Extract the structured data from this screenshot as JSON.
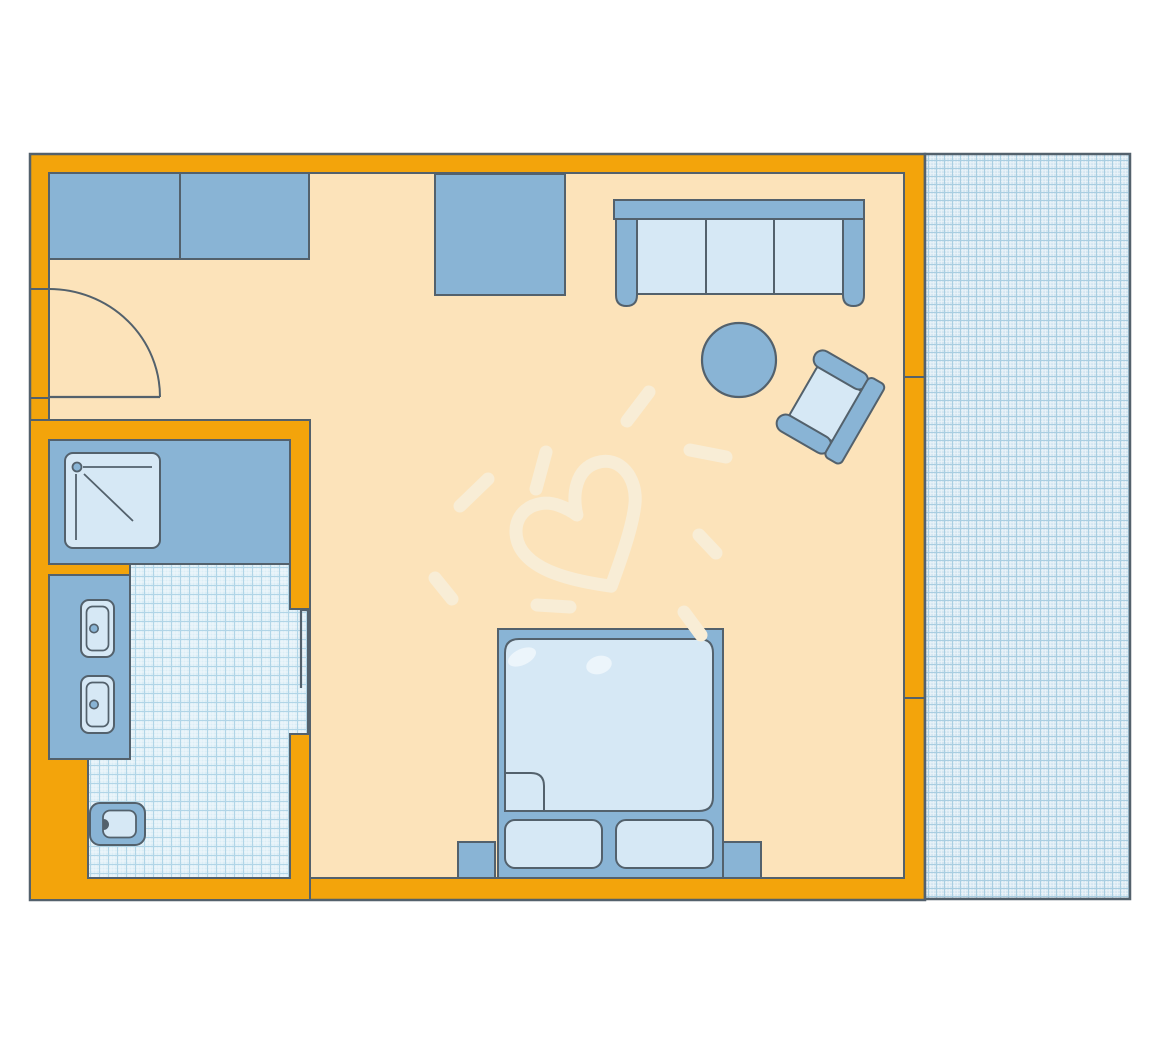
{
  "title": "hotel-room-floor-plan",
  "colors": {
    "page_bg": "#ffffff",
    "wall": "#F3A40B",
    "outline": "#53616C",
    "floor": "#FCE3BA",
    "furniture_blue": "#89B4D5",
    "furniture_light": "#D6E8F5",
    "balcony_bg": "#D4E6F1",
    "balcony_grid": "#A9CEE1",
    "tile_bg": "#DBEDF6",
    "tile_grid": "#B1D5E7",
    "sketch": "#F8EDD6",
    "highlight": "rgba(255,255,255,0.55)"
  },
  "rooms": [
    {
      "id": "living-sleeping-area"
    },
    {
      "id": "bathroom"
    },
    {
      "id": "balcony-terrace"
    }
  ],
  "furniture": [
    "wardrobe",
    "desk",
    "sofa",
    "coffee-table",
    "armchair",
    "double-bed",
    "duvet-fold",
    "pillow",
    "pillow",
    "nightstand-left",
    "nightstand-right",
    "shower-tray",
    "vanity-counter",
    "washbasin",
    "washbasin",
    "toilet"
  ],
  "annotations": [
    "entry-door-swing",
    "bathroom-door-leaf",
    "heart-sketch",
    "sketch-rays",
    "wall-joints"
  ]
}
